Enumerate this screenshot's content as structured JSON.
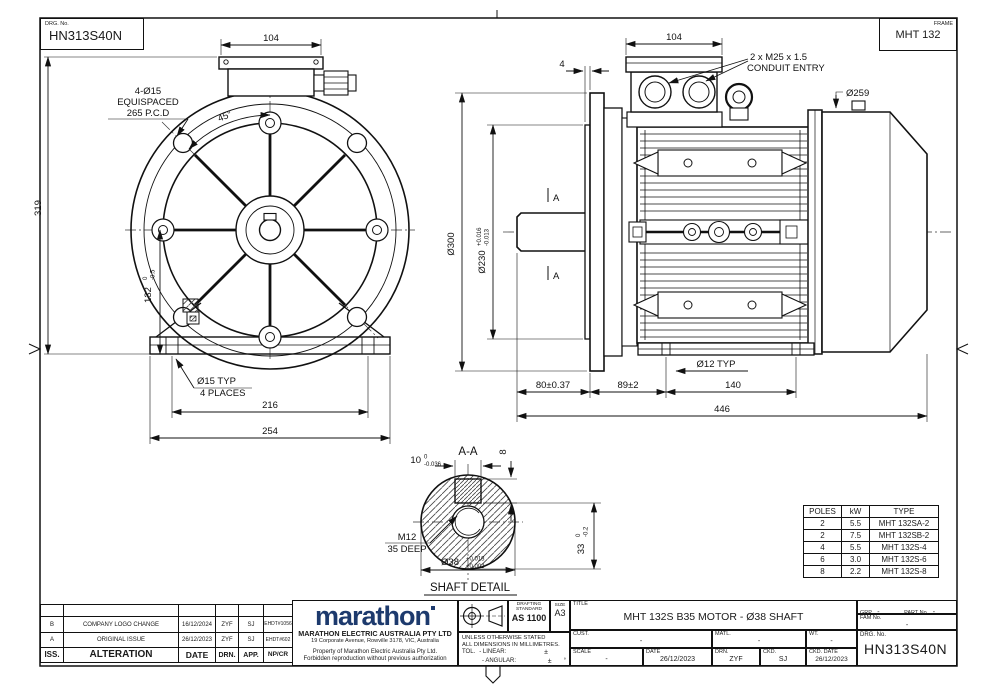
{
  "colors": {
    "ink": "#1a1a1a",
    "logo_navy": "#1d3a6d"
  },
  "header": {
    "drg_no_label": "DRG. No.",
    "drg_no": "HN313S40N",
    "frame_label": "FRAME",
    "frame_value": "MHT 132"
  },
  "front": {
    "dim_box_width": "104",
    "holes_qty": "4-Ø15",
    "holes_spacing": "EQUISPACED",
    "holes_pcd": "265 P.C.D",
    "angle": "45°",
    "dim_height": "319",
    "dim_centre_height": "132",
    "centre_tol_hi": "0",
    "centre_tol_lo": "-0.5",
    "foot_hole": "Ø15 TYP",
    "foot_hole_qty": "4 PLACES",
    "dim_foot_span": "216",
    "dim_base_width": "254"
  },
  "side": {
    "dim_box_width": "104",
    "dim_spigot": "4",
    "conduit_line1": "2 x M25 x 1.5",
    "conduit_line2": "CONDUIT ENTRY",
    "dim_cowl": "Ø259",
    "dim_flange": "Ø300",
    "dim_spigot_dia": "Ø230",
    "spigot_tol_hi": "+0.016",
    "spigot_tol_lo": "-0.013",
    "datum": "A",
    "dim_shaft_len": "80±0.37",
    "dim_flange_to_foot": "89±2",
    "foot_hole": "Ø12 TYP",
    "dim_foot_span": "140",
    "dim_total": "446"
  },
  "detail": {
    "section": "A-A",
    "key_width": "10",
    "key_width_tol_hi": "0",
    "key_width_tol_lo": "-0.036",
    "key_height": "8",
    "tap": "M12",
    "tap_depth": "35 DEEP",
    "shaft_dia": "Ø38",
    "shaft_tol_hi": "+0.018",
    "shaft_tol_lo": "+0.002",
    "key_depth": "33",
    "key_depth_tol_hi": "0",
    "key_depth_tol_lo": "-0.2",
    "caption": "SHAFT DETAIL"
  },
  "ratings": {
    "headers": [
      "POLES",
      "kW",
      "TYPE"
    ],
    "rows": [
      [
        "2",
        "5.5",
        "MHT 132SA-2"
      ],
      [
        "2",
        "7.5",
        "MHT 132SB-2"
      ],
      [
        "4",
        "5.5",
        "MHT 132S-4"
      ],
      [
        "6",
        "3.0",
        "MHT 132S-6"
      ],
      [
        "8",
        "2.2",
        "MHT 132S-8"
      ]
    ]
  },
  "revision": {
    "headers": {
      "iss": "ISS.",
      "alteration": "ALTERATION",
      "date": "DATE",
      "drn": "DRN.",
      "app": "APP.",
      "npcr": "NP/CR"
    },
    "rows": [
      {
        "iss": "B",
        "alteration": "COMPANY LOGO CHANGE",
        "date": "16/12/2024",
        "drn": "ZYF",
        "app": "SJ",
        "npcr": "EHDT#1056"
      },
      {
        "iss": "A",
        "alteration": "ORIGINAL ISSUE",
        "date": "26/12/2023",
        "drn": "ZYF",
        "app": "SJ",
        "npcr": "EHDT#602"
      }
    ]
  },
  "company": {
    "logo": "marathon",
    "name": "MARATHON ELECTRIC AUSTRALIA PTY LTD",
    "address": "19 Corporate Avenue, Rowville 3178, VIC, Australia",
    "notice1": "Property of Marathon Electric Australia Pty Ltd.",
    "notice2": "Forbidden reproduction without previous authorization"
  },
  "standards": {
    "drafting_line1": "DRAFTING",
    "drafting_line2": "STANDARD",
    "drafting_value": "AS 1100",
    "size_label": "SIZE",
    "size_value": "A3",
    "note1": "UNLESS OTHERWISE STATED",
    "note2": "ALL DIMENSIONS IN MILLIMETRES.",
    "tol_label": "TOL.",
    "linear_label": "- LINEAR:",
    "angular_label": "- ANGULAR:",
    "pm": "±",
    "deg": "°"
  },
  "info": {
    "title_label": "TITLE",
    "title": "MHT 132S  B35 MOTOR - Ø38 SHAFT",
    "grp_label": "GRP.",
    "grp": "-",
    "part_label": "PART No.",
    "part": "-",
    "fam_label": "FAM No.",
    "fam": "-",
    "cust_label": "CUST.",
    "cust": "-",
    "matl_label": "MATL.",
    "matl": "-",
    "wt_label": "WT.",
    "wt": "-",
    "drg_label": "DRG. No.",
    "drg": "HN313S40N",
    "scale_label": "SCALE",
    "scale": "-",
    "date_label": "DATE",
    "date": "26/12/2023",
    "drn_label": "DRN.",
    "drn": "ZYF",
    "ckd_label": "CKD.",
    "ckd": "SJ",
    "ckd_date_label": "CKD. DATE",
    "ckd_date": "26/12/2023"
  }
}
